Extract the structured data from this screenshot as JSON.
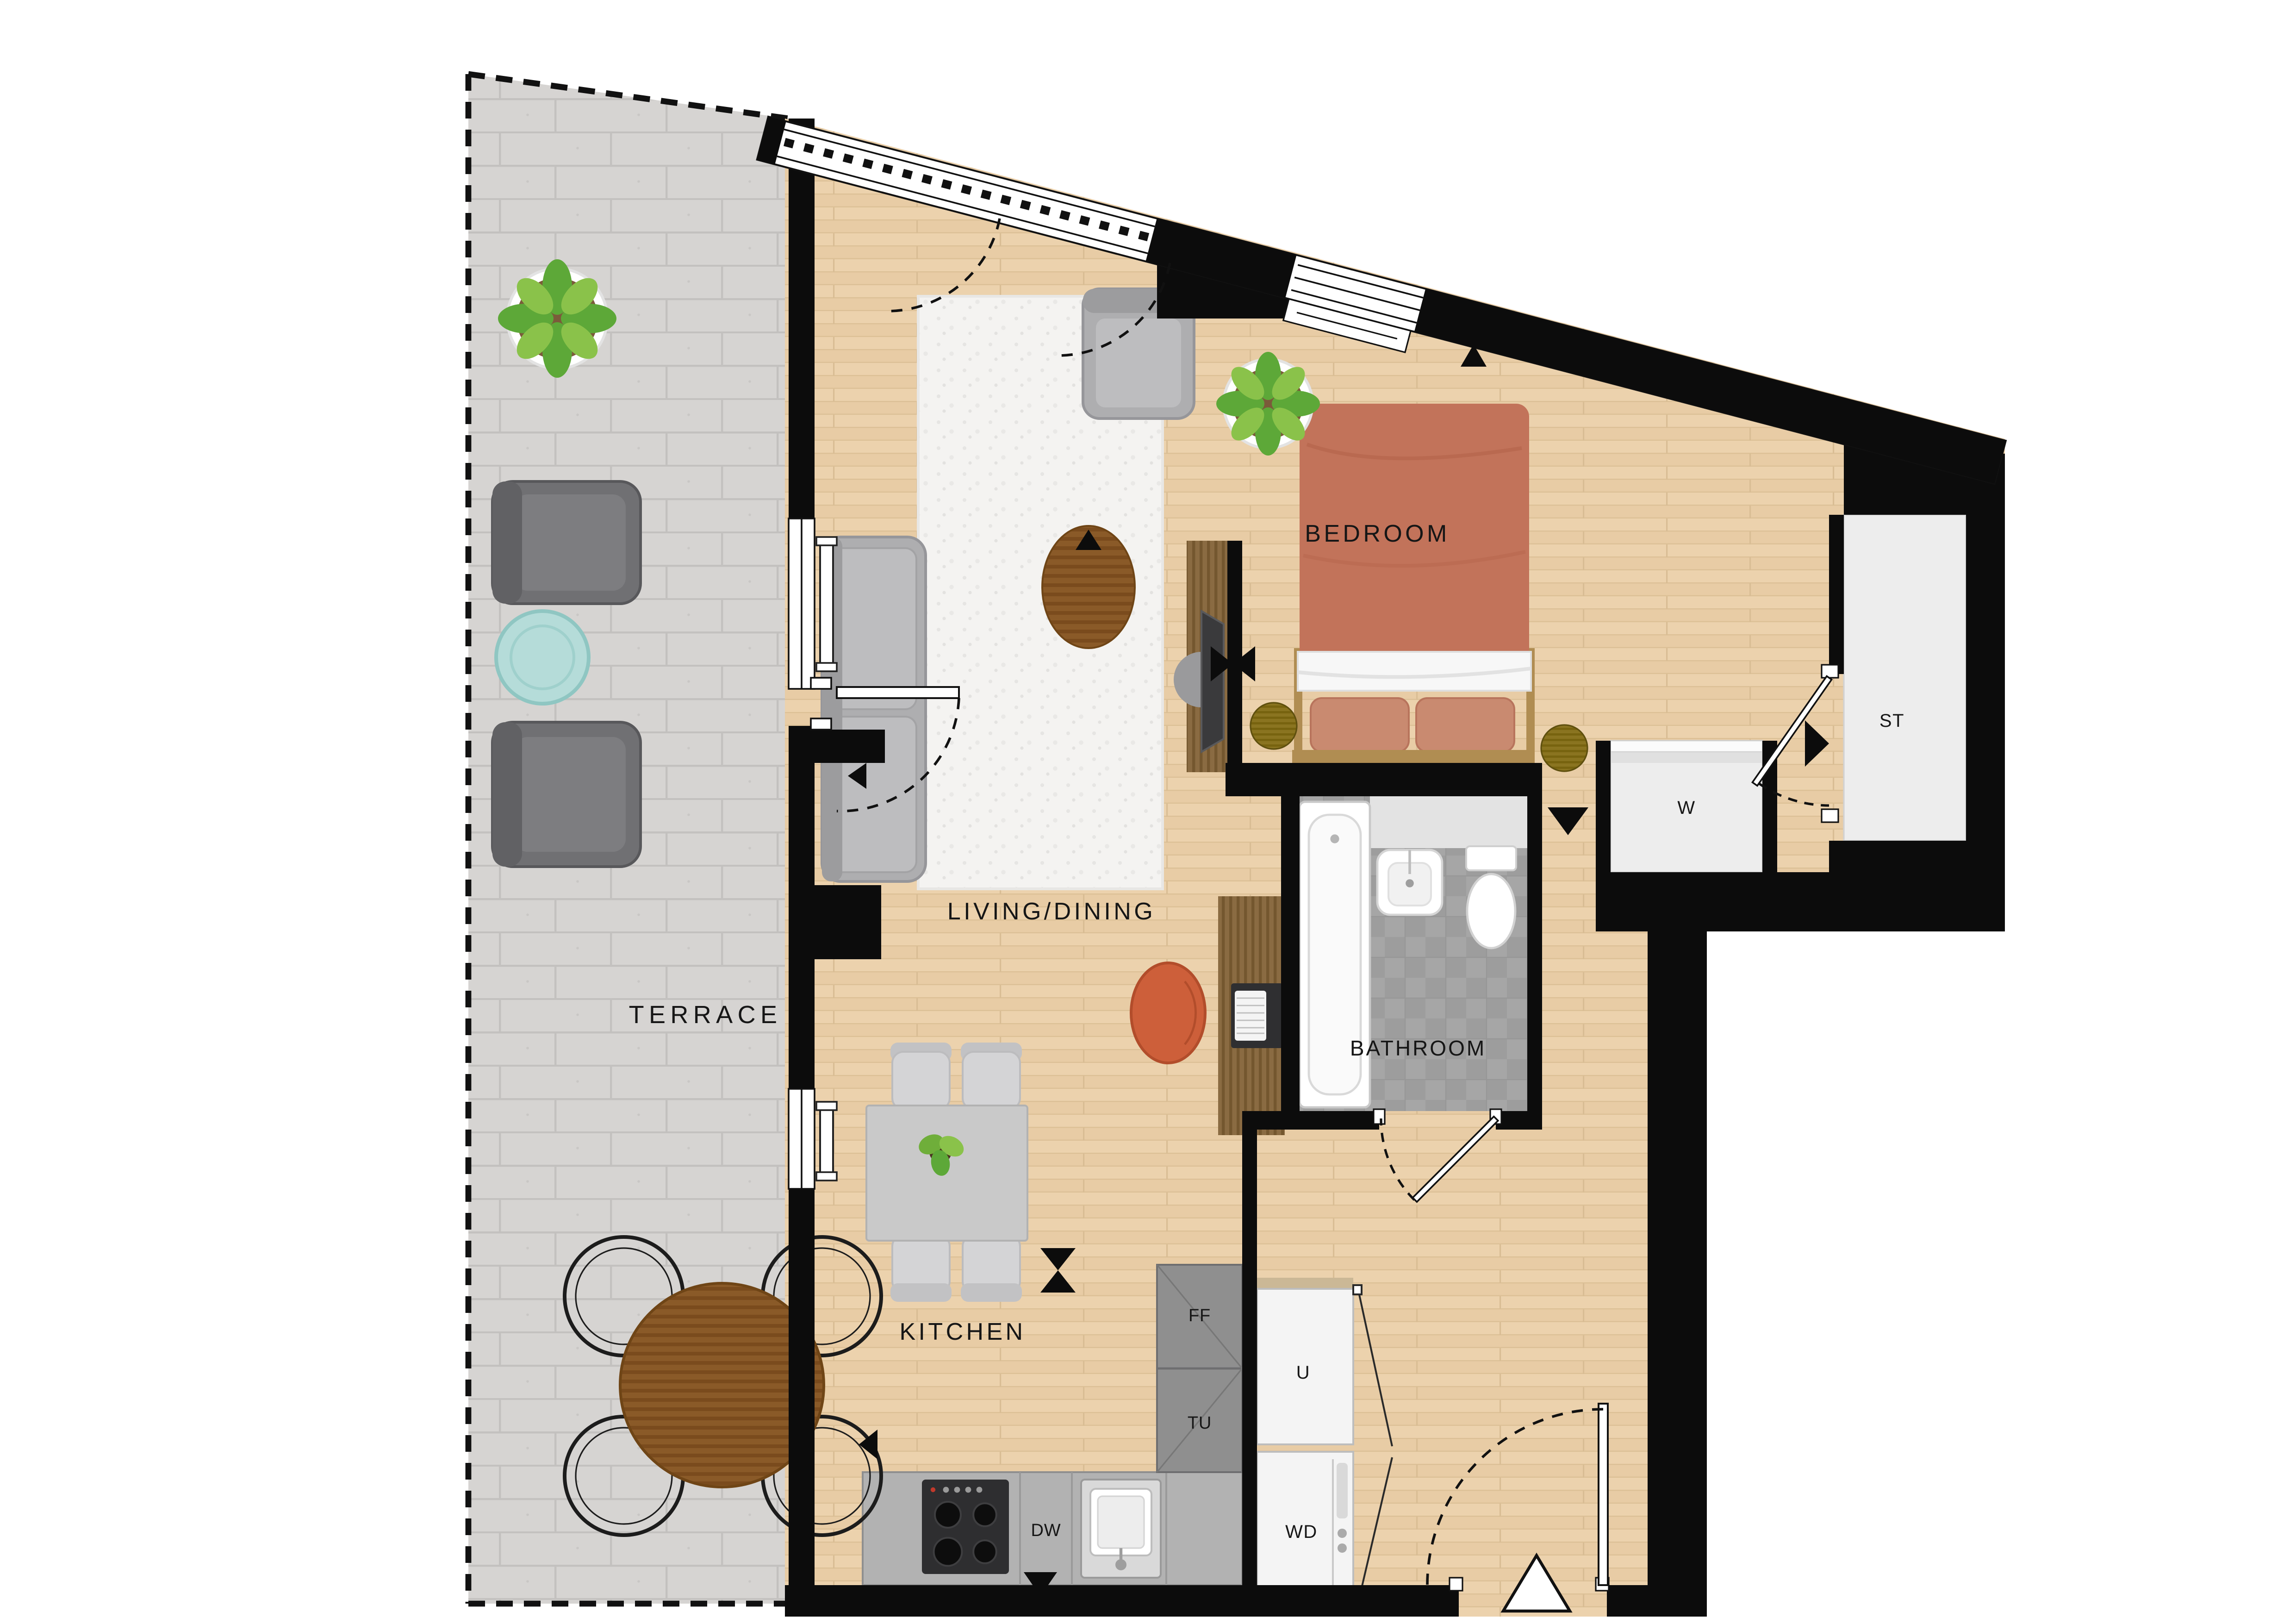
{
  "plan_title": "one-bedroom-apartment-floor-plan",
  "rooms": {
    "terrace": {
      "label": "TERRACE"
    },
    "living_dining": {
      "label": "LIVING/DINING"
    },
    "kitchen": {
      "label": "KITCHEN"
    },
    "bedroom": {
      "label": "BEDROOM"
    },
    "bathroom": {
      "label": "BATHROOM"
    }
  },
  "storage": {
    "store_cupboard": {
      "label": "ST"
    },
    "wardrobe": {
      "label": "W"
    }
  },
  "appliances": {
    "fridge_freezer": {
      "label": "FF"
    },
    "tall_unit": {
      "label": "TU"
    },
    "utility_cupboard": {
      "label": "U"
    },
    "washer_dryer": {
      "label": "WD"
    },
    "dishwasher": {
      "label": "DW"
    }
  },
  "colors": {
    "wall": "#0c0c0c",
    "wood_floor": "#ecd2ad",
    "terrace_paving": "#d6d4d2",
    "bathroom_tile": "#a6a6a6",
    "closet_fill": "#ededed",
    "rug": "#f4f3f1",
    "sofa_gray": "#aeaeb0",
    "bed_terracotta": "#c2735a",
    "pillow": "#c98a70",
    "wood_furniture": "#8a5a28",
    "desk_chair_orange": "#cd5f3a",
    "plant_green": "#6fae3a",
    "teal_table": "#b5dcd9",
    "counter_gray": "#b2b2b2",
    "unit_gray": "#8f8f8f",
    "bedside_olive": "#8a7420"
  }
}
